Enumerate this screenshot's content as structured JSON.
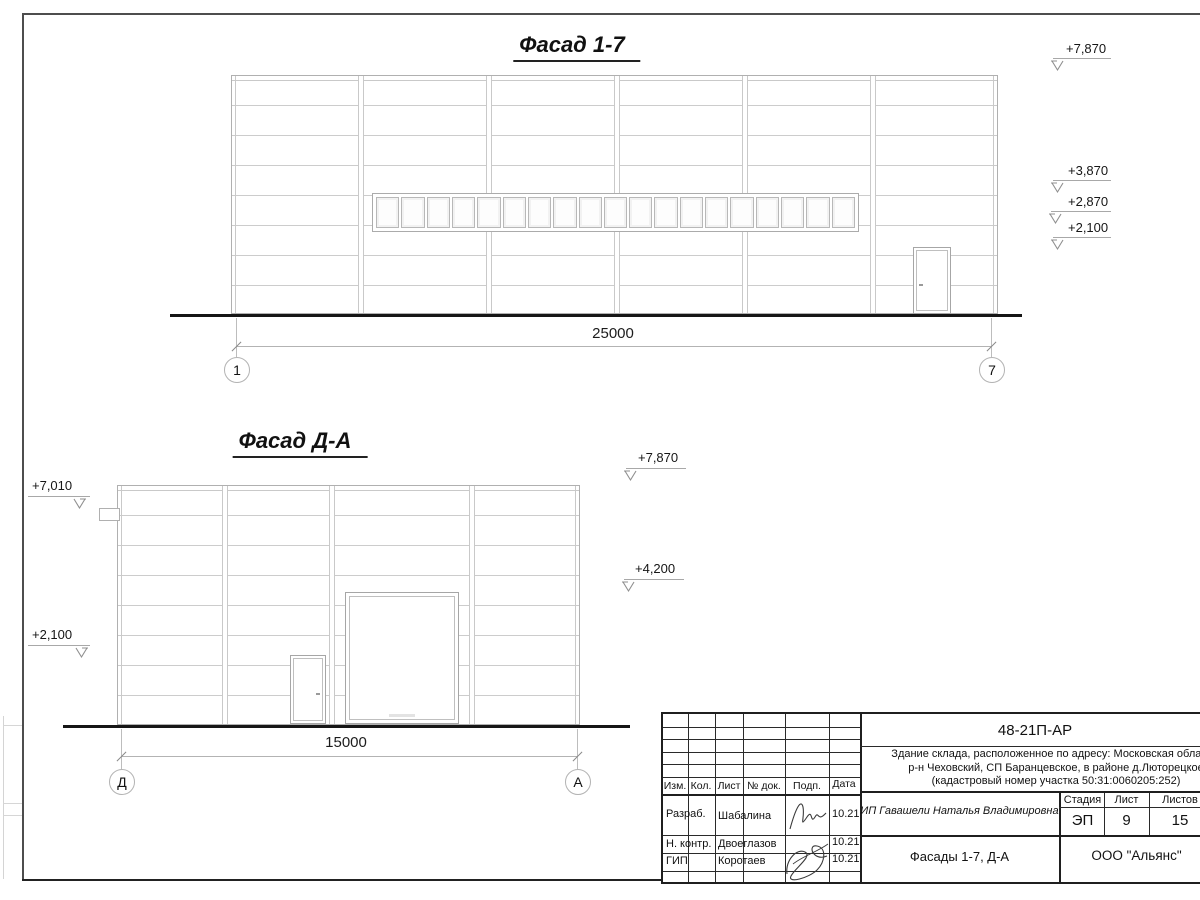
{
  "f1": {
    "title": "Фасад 1-7",
    "dim": "25000",
    "ax_left": "1",
    "ax_right": "7",
    "e1": "+7,870",
    "e2": "+3,870",
    "e3": "+2,870",
    "e4": "+2,100",
    "window_panes": 19
  },
  "f2": {
    "title": "Фасад Д-А",
    "dim": "15000",
    "ax_left": "Д",
    "ax_right": "А",
    "el1": "+7,010",
    "el2": "+2,100",
    "er1": "+7,870",
    "er2": "+4,200"
  },
  "tb": {
    "code": "48-21П-АР",
    "desc1": "Здание склада, расположенное по адресу: Московская область,",
    "desc2": "р-н Чеховский, СП Баранцевское, в районе д.Люторецкое",
    "desc3": "(кадастровый номер участка 50:31:0060205:252)",
    "col_izm": "Изм.",
    "col_kol": "Кол.",
    "col_list": "Лист",
    "col_doc": "№ док.",
    "col_podp": "Подп.",
    "col_data": "Дата",
    "r1_role": "Разраб.",
    "r1_name": "Шабалина",
    "r1_date": "10.21",
    "r2_role": "Н. контр.",
    "r2_name": "Двоеглазов",
    "r2_date": "10.21",
    "r3_role": "ГИП",
    "r3_name": "Коротаев",
    "r3_date": "10.21",
    "client": "ИП Гавашели Наталья Владимировна",
    "stage_label": "Стадия",
    "sheet_label": "Лист",
    "sheets_label": "Листов",
    "stage": "ЭП",
    "sheet": "9",
    "sheets": "15",
    "sheet_title": "Фасады 1-7, Д-А",
    "company": "ООО \"Альянс\""
  }
}
